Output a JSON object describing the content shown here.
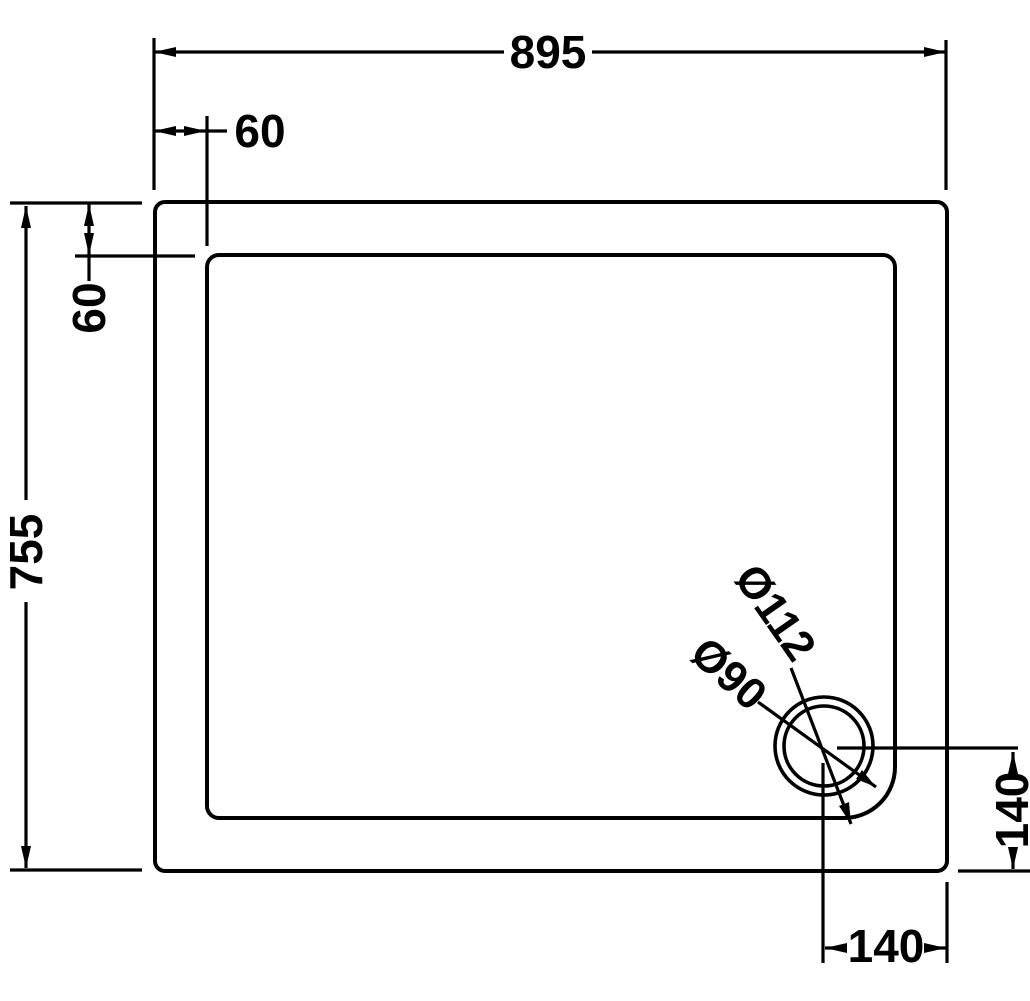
{
  "drawing": {
    "background_color": "#ffffff",
    "line_color": "#000000",
    "dimensions": {
      "overall_width": "895",
      "top_inset": "60",
      "left_inset": "60",
      "overall_depth": "755",
      "waste_offset_right": "140",
      "waste_offset_bottom": "140",
      "waste_outer_diameter": "Ø112",
      "waste_inner_diameter": "Ø90"
    }
  }
}
